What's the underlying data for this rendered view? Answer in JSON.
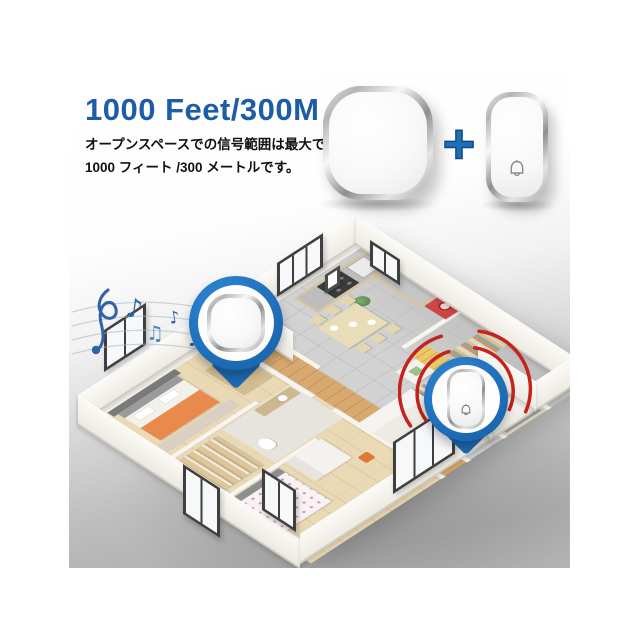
{
  "hero": {
    "title": "1000 Feet/300M",
    "description_line1": "オープンスペースでの信号範囲は最大で",
    "description_line2": "1000 フィート /300 メートルです。",
    "plus_sign": "+"
  },
  "colors": {
    "title_blue": "#1e5ca7",
    "pin_blue": "#1f6fba",
    "plus_blue": "#1e6fbb",
    "signal_red": "#c5231d",
    "note_blue": "#2f62a8"
  },
  "icons": {
    "receiver": "doorbell-chime-receiver",
    "doorbell_button": "wireless-doorbell-button",
    "bell": "bell-outline-icon",
    "plus": "plus-icon",
    "receiver_pin": "location-pin-with-receiver",
    "button_pin": "location-pin-with-doorbell-button",
    "music_notes": "music-notes-icon",
    "signal_waves": "signal-waves-icon"
  },
  "floorplan": {
    "scene": "isometric-3d-house-floor-plan",
    "notes": [
      "♪",
      "♫",
      "♪",
      "♫",
      "♬",
      "♪",
      "♩"
    ]
  }
}
